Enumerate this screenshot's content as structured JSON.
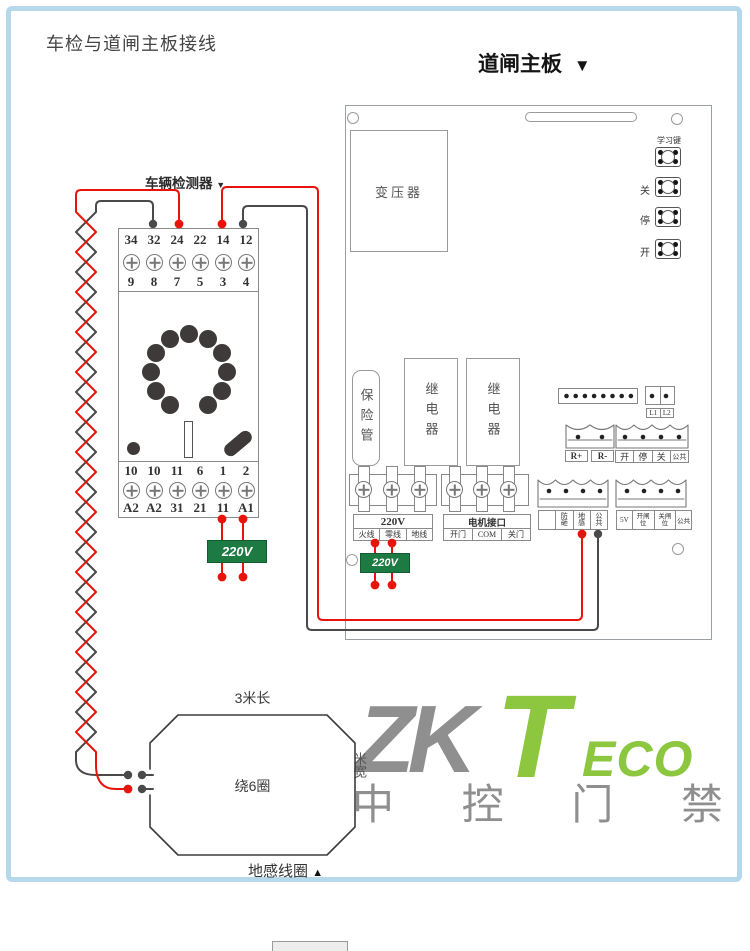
{
  "page": {
    "title": "车检与道闸主板接线"
  },
  "board": {
    "title": "道闸主板",
    "title_arrow": "▼",
    "transformer": "变压器",
    "fuse": "保险管",
    "relay1": "继电器",
    "relay2": "继电器",
    "buttons": {
      "learn": "学习键",
      "close": "关",
      "stop": "停",
      "open": "开"
    },
    "power_block": {
      "title": "220V",
      "cells": [
        "火线",
        "零线",
        "地线"
      ]
    },
    "motor_block": {
      "title": "电机接口",
      "cells": [
        "开门",
        "COM",
        "关门"
      ]
    },
    "l_labels": [
      "L1",
      "L2"
    ],
    "r_labels": [
      "R+",
      "R-"
    ],
    "cmd_labels": [
      "开",
      "停",
      "关",
      "公共"
    ],
    "sense_labels": [
      "",
      "防砸",
      "地感",
      "公共"
    ],
    "limit_labels": [
      "5V",
      "开闸位",
      "关闸位",
      "公共"
    ],
    "power_tag": "220V"
  },
  "detector": {
    "title": "车辆检测器",
    "title_arrow": "▼",
    "top_numbers": [
      "34",
      "32",
      "24",
      "22",
      "14",
      "12"
    ],
    "top_pins": [
      "9",
      "8",
      "7",
      "5",
      "3",
      "4"
    ],
    "bottom_numbers": [
      "10",
      "10",
      "11",
      "6",
      "1",
      "2"
    ],
    "bottom_labels": [
      "A2",
      "A2",
      "31",
      "21",
      "11",
      "A1"
    ],
    "power_tag": "220V"
  },
  "coil": {
    "length_label": "3米长",
    "turns_label": "绕6圈",
    "name": "地感线圈",
    "name_arrow": "▲",
    "width_label": "米宽"
  },
  "watermark": {
    "zk": "ZK",
    "t": "T",
    "eco": "ECO",
    "cn": "中 控 门 禁"
  },
  "colors": {
    "wire_red": "#e8140c",
    "wire_dark": "#4a4a4a",
    "tag_green": "#1d7a42",
    "frame_blue": "#b5d8ea",
    "logo_green": "#8dc63f",
    "logo_gray": "#8f8f8f",
    "line_gray": "#8c8c8c"
  }
}
